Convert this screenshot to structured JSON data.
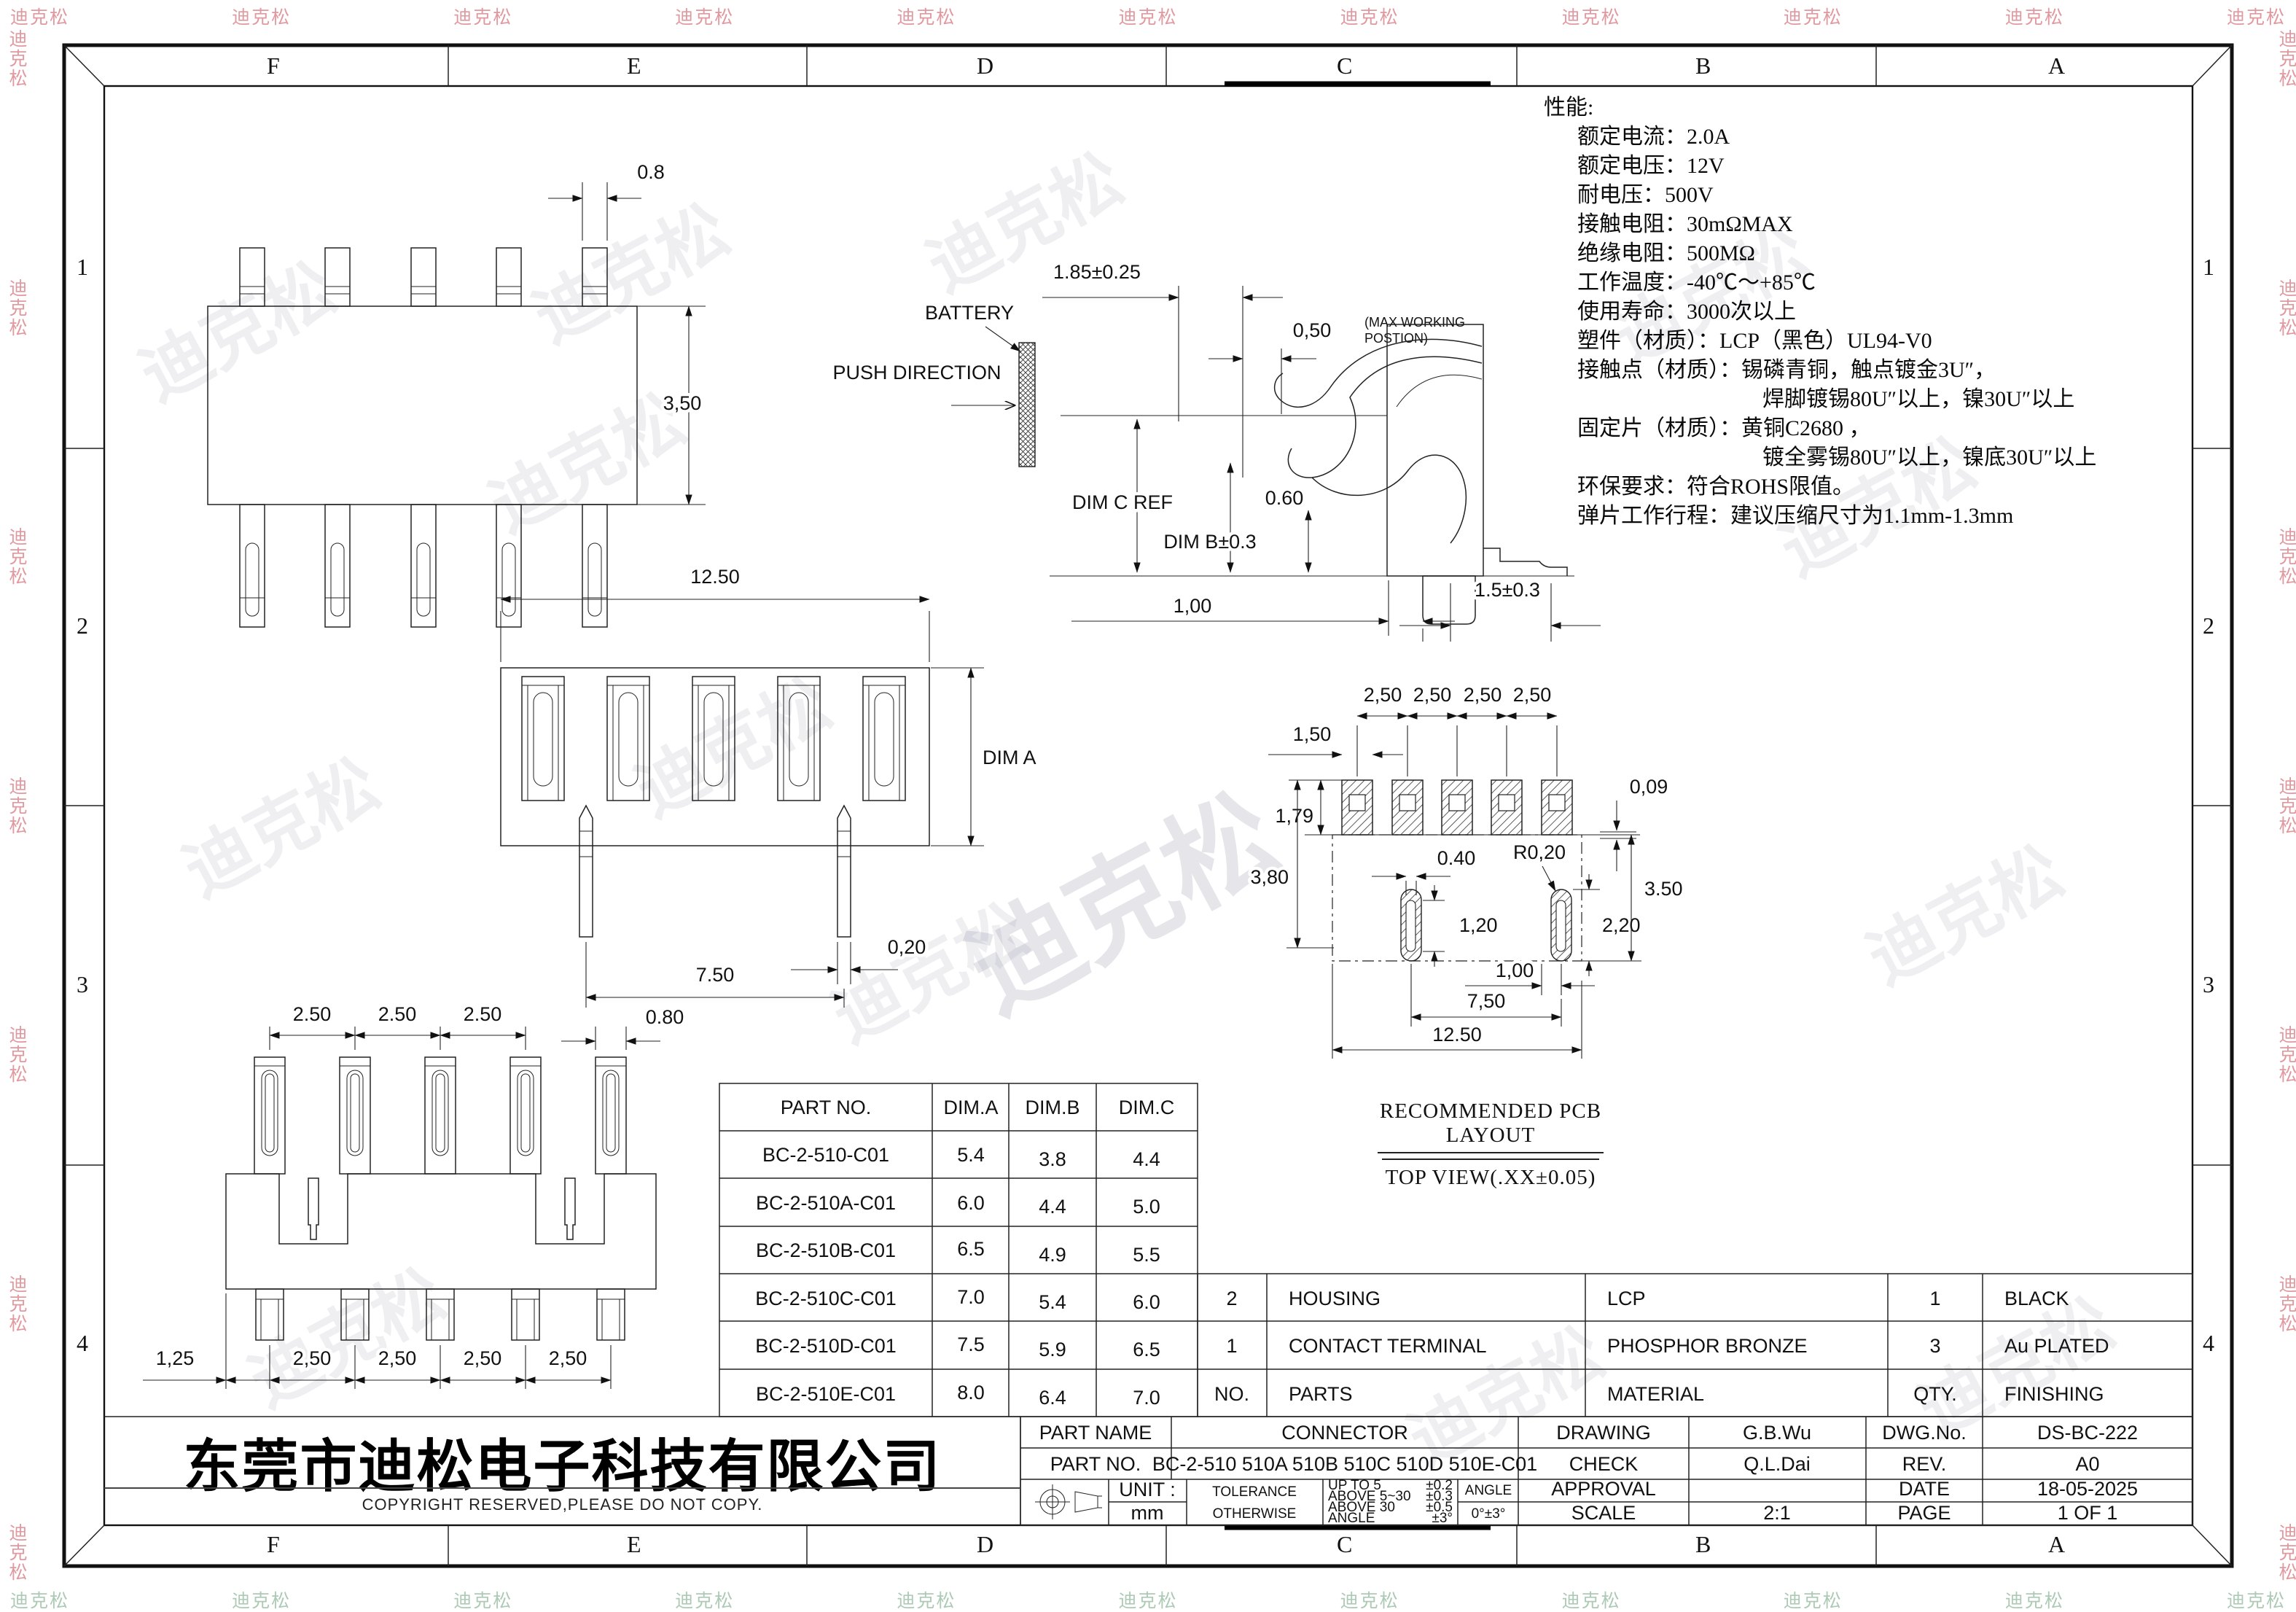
{
  "watermark": {
    "text": "迪克松"
  },
  "border": {
    "cols": [
      "F",
      "E",
      "D",
      "C",
      "B",
      "A"
    ],
    "rows": [
      "1",
      "2",
      "3",
      "4"
    ]
  },
  "specs": {
    "title": "性能:",
    "items": [
      "额定电流：2.0A",
      "额定电压：12V",
      "耐电压：500V",
      "接触电阻：30mΩMAX",
      "绝缘电阻：500MΩ",
      "工作温度：-40℃～+85℃",
      "使用寿命：3000次以上",
      "塑件（材质）：LCP（黑色）UL94-V0",
      "接触点（材质）：锡磷青铜，触点镀金3U″，",
      "焊脚镀锡80U″以上，镍30U″以上",
      "固定片（材质）：黄铜C2680 ，",
      "镀全雾锡80U″以上，镍底30U″以上",
      "环保要求：符合ROHS限值。",
      "弹片工作行程：建议压缩尺寸为1.1mm-1.3mm"
    ]
  },
  "views": {
    "top": {
      "tab": "0.8",
      "height": "3,50"
    },
    "side": {
      "depth": "1.85±0.25",
      "work": "0,50",
      "note1": "(MAX WORKING",
      "note2": "POSTION)",
      "battery": "BATTERY",
      "push": "PUSH DIRECTION",
      "dimc": "DIM C REF",
      "dimb": "DIM B±0.3",
      "d060": "0.60",
      "d100": "1,00",
      "foot": "1.5±0.3"
    },
    "front": {
      "width": "12.50",
      "height": "DIM A",
      "pitch": "7.50",
      "pin": "0,20"
    },
    "bottom": {
      "p250a": "2.50",
      "w080": "0.80",
      "off": "1,25",
      "p250b": "2,50"
    },
    "pcb": {
      "pitch": "2,50",
      "pad": "1,50",
      "d009": "0,09",
      "d179": "1,79",
      "d380": "3,80",
      "d040": "0.40",
      "rad": "R0,20",
      "d120": "1,20",
      "d220": "2,20",
      "d350": "3.50",
      "d100": "1,00",
      "d750": "7,50",
      "d1250": "12.50",
      "cap1": "RECOMMENDED PCB LAYOUT",
      "cap2": "TOP VIEW(.XX±0.05)"
    }
  },
  "part_table": {
    "headers": [
      "PART NO.",
      "DIM.A",
      "DIM.B",
      "DIM.C"
    ],
    "rows": [
      [
        "BC-2-510-C01",
        "5.4",
        "3.8",
        "4.4"
      ],
      [
        "BC-2-510A-C01",
        "6.0",
        "4.4",
        "5.0"
      ],
      [
        "BC-2-510B-C01",
        "6.5",
        "4.9",
        "5.5"
      ],
      [
        "BC-2-510C-C01",
        "7.0",
        "5.4",
        "6.0"
      ],
      [
        "BC-2-510D-C01",
        "7.5",
        "5.9",
        "6.5"
      ],
      [
        "BC-2-510E-C01",
        "8.0",
        "6.4",
        "7.0"
      ]
    ]
  },
  "bom_table": {
    "rows": [
      [
        "2",
        "HOUSING",
        "LCP",
        "1",
        "BLACK"
      ],
      [
        "1",
        "CONTACT TERMINAL",
        "PHOSPHOR BRONZE",
        "3",
        "Au PLATED"
      ],
      [
        "NO.",
        "PARTS",
        "MATERIAL",
        "QTY.",
        "FINISHING"
      ]
    ]
  },
  "title_block": {
    "part_name_label": "PART NAME",
    "part_name": "CONNECTOR",
    "drawing_label": "DRAWING",
    "drawing": "G.B.Wu",
    "dwgno_label": "DWG.No.",
    "dwgno": "DS-BC-222",
    "partno_label": "PART NO.",
    "partno": "BC-2-510 510A 510B 510C 510D 510E-C01",
    "check_label": "CHECK",
    "check": "Q.L.Dai",
    "rev_label": "REV.",
    "rev": "A0",
    "unit_label": "UNIT :",
    "unit": "mm",
    "tol_label1": "TOLERANCE",
    "tol_label2": "OTHERWISE",
    "tol_rows": [
      [
        "UP TO 5",
        "±0.2"
      ],
      [
        "ABOVE 5~30",
        "±0.3"
      ],
      [
        "ABOVE 30",
        "±0.5"
      ],
      [
        "ANGLE",
        "±3°"
      ]
    ],
    "angle_label": "ANGLE",
    "angle": "0°±3°",
    "approval_label": "APPROVAL",
    "approval": "",
    "date_label": "DATE",
    "date": "18-05-2025",
    "scale_label": "SCALE",
    "scale": "2:1",
    "page_label": "PAGE",
    "page": "1 OF 1"
  },
  "company": {
    "name": "东莞市迪松电子科技有限公司",
    "copyright": "COPYRIGHT RESERVED,PLEASE DO NOT COPY."
  }
}
